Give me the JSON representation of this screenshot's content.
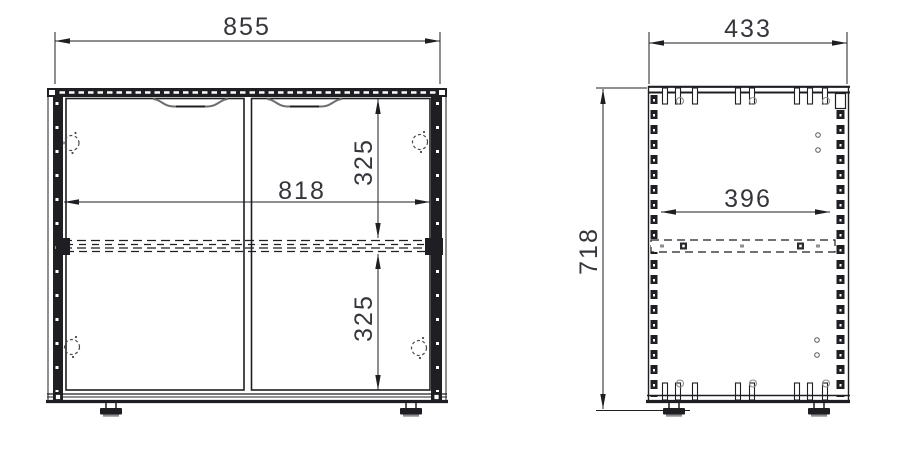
{
  "drawing": {
    "kind": "cabinet-orthographic-views",
    "views": {
      "front_view": {
        "name": "front view",
        "dims": {
          "overall_width": "855",
          "inner_width": "818",
          "upper_section_height": "325",
          "lower_section_height": "325"
        }
      },
      "side_view": {
        "name": "side view",
        "dims": {
          "overall_depth": "433",
          "inner_depth": "396",
          "overall_height": "718"
        }
      }
    },
    "colors": {
      "line": "#1f1f23",
      "dim_text": "#35363c",
      "shade_gray": "#8e8e8e",
      "background": "#ffffff"
    }
  }
}
